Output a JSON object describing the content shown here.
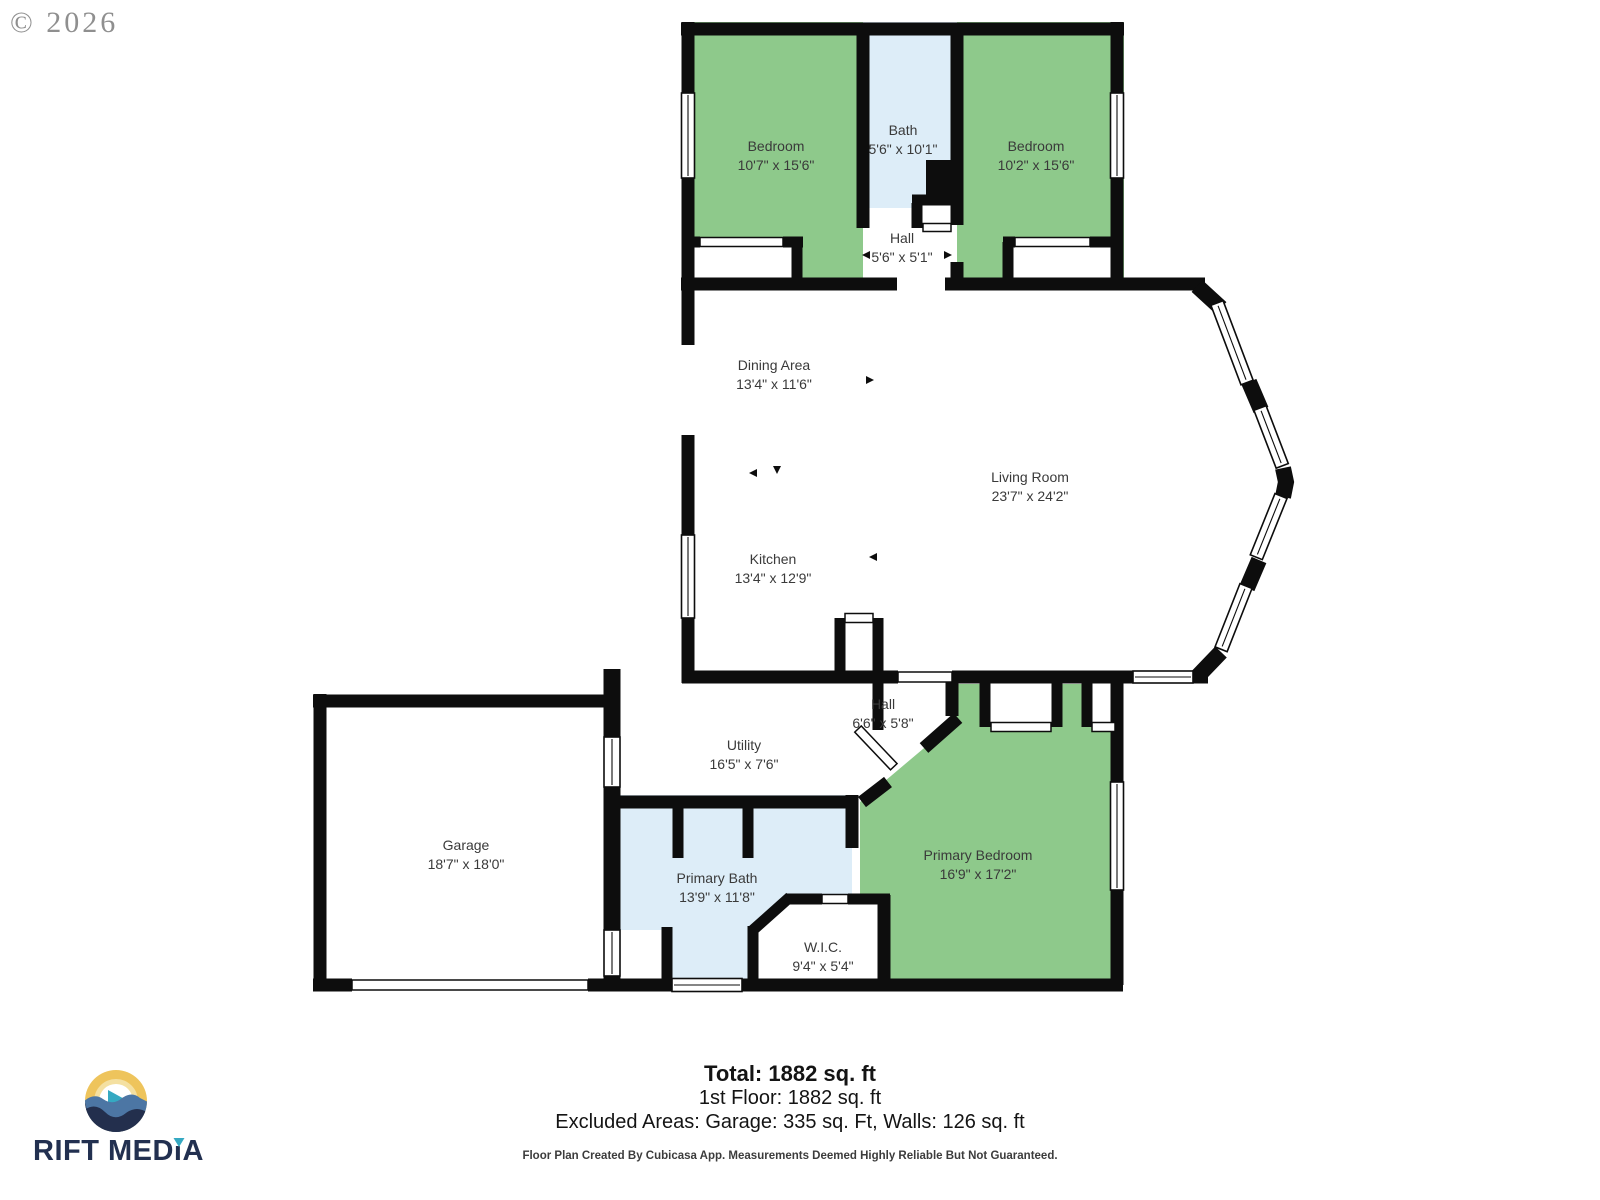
{
  "copyright": "© 2026",
  "rooms": [
    {
      "name": "Bedroom",
      "dims": "10'7\" x 15'6\""
    },
    {
      "name": "Bath",
      "dims": "5'6\" x 10'1\""
    },
    {
      "name": "Bedroom",
      "dims": "10'2\" x 15'6\""
    },
    {
      "name": "Hall",
      "dims": "5'6\" x 5'1\""
    },
    {
      "name": "Dining Area",
      "dims": "13'4\" x 11'6\""
    },
    {
      "name": "Living Room",
      "dims": "23'7\" x 24'2\""
    },
    {
      "name": "Kitchen",
      "dims": "13'4\" x 12'9\""
    },
    {
      "name": "Hall",
      "dims": "6'6\" x 5'8\""
    },
    {
      "name": "Utility",
      "dims": "16'5\" x 7'6\""
    },
    {
      "name": "Garage",
      "dims": "18'7\" x 18'0\""
    },
    {
      "name": "Primary Bath",
      "dims": "13'9\" x 11'8\""
    },
    {
      "name": "W.I.C.",
      "dims": "9'4\" x 5'4\""
    },
    {
      "name": "Primary Bedroom",
      "dims": "16'9\" x 17'2\""
    }
  ],
  "summary": {
    "total": "Total: 1882 sq. ft",
    "first_floor": "1st Floor: 1882 sq. ft",
    "excluded": "Excluded Areas: Garage: 335 sq. Ft, Walls: 126 sq. ft",
    "disclaimer": "Floor Plan Created By Cubicasa App. Measurements Deemed Highly Reliable But Not Guaranteed."
  },
  "logo": {
    "text": "RIFT MEDiA"
  },
  "colors": {
    "bedroom_green": "#8ec98b",
    "bath_blue": "#ddedf8",
    "wall_black": "#0d0d0d",
    "label_gray": "#3a3a3a",
    "copyright_gray": "#8f8f8f",
    "logo_navy": "#223050",
    "logo_teal": "#35a9c2",
    "logo_yellow": "#eec45c",
    "logo_wave_blue": "#4c76a4",
    "logo_wave_navy": "#232f4d"
  }
}
